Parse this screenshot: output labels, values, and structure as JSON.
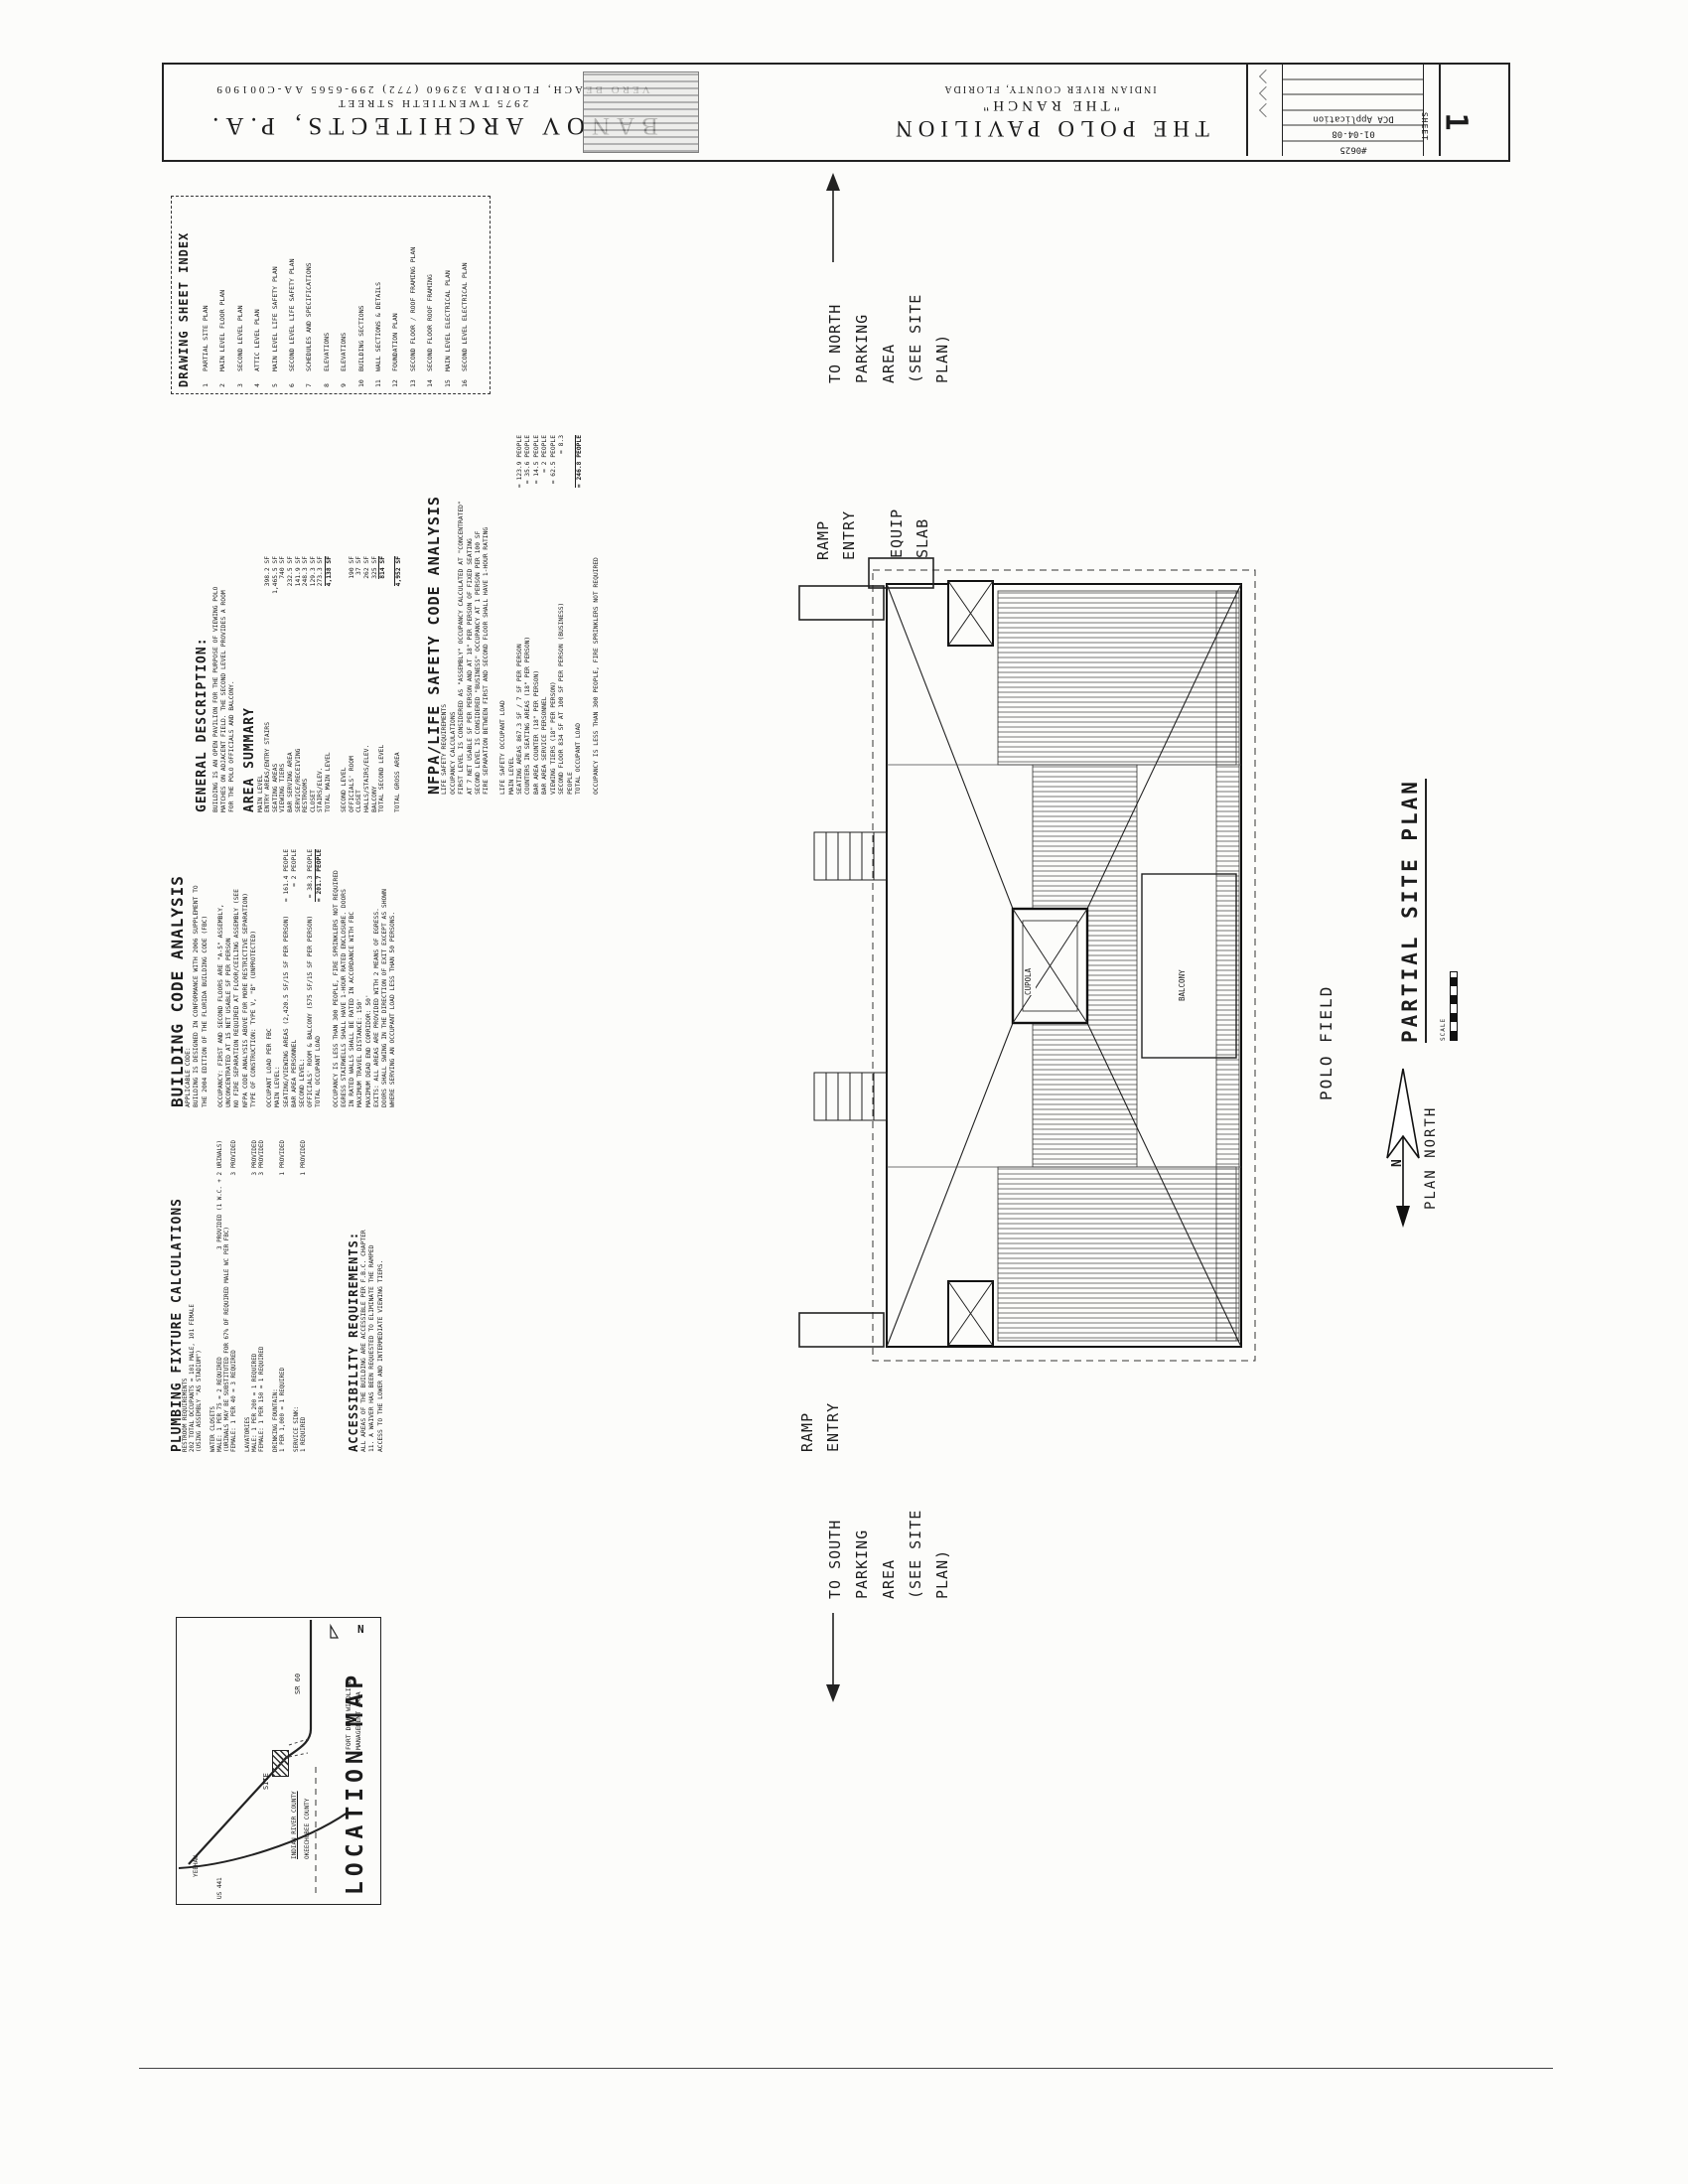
{
  "title_block": {
    "architect": {
      "name": "BANOV ARCHITECTS, P.A.",
      "address": "2975 TWENTIETH STREET",
      "city_line": "VERO BEACH, FLORIDA 32960 (772) 299-6565 AA-C001909"
    },
    "project": {
      "name": "THE POLO PAVILION",
      "subtitle": "\"THE RANCH\"",
      "location": "INDIAN RIVER COUNTY, FLORIDA"
    },
    "info_rows": [
      "",
      "",
      "",
      "DCA Application",
      "01-04-08",
      "#0625"
    ],
    "sheet_label": "SHEET",
    "sheet_number": "1"
  },
  "sheet_index": {
    "title": "DRAWING SHEET INDEX",
    "entries": [
      {
        "num": "1",
        "label": "PARTIAL SITE PLAN"
      },
      {
        "num": "2",
        "label": "MAIN LEVEL FLOOR PLAN"
      },
      {
        "num": "3",
        "label": "SECOND LEVEL PLAN"
      },
      {
        "num": "4",
        "label": "ATTIC LEVEL PLAN"
      },
      {
        "num": "5",
        "label": "MAIN LEVEL LIFE SAFETY PLAN"
      },
      {
        "num": "6",
        "label": "SECOND LEVEL LIFE SAFETY PLAN"
      },
      {
        "num": "7",
        "label": "SCHEDULES AND SPECIFICATIONS"
      },
      {
        "num": "8",
        "label": "ELEVATIONS"
      },
      {
        "num": "9",
        "label": "ELEVATIONS"
      },
      {
        "num": "10",
        "label": "BUILDING SECTIONS"
      },
      {
        "num": "11",
        "label": "WALL SECTIONS & DETAILS"
      },
      {
        "num": "12",
        "label": "FOUNDATION PLAN"
      },
      {
        "num": "13",
        "label": "SECOND FLOOR / ROOF FRAMING PLAN"
      },
      {
        "num": "14",
        "label": "SECOND FLOOR ROOF FRAMING"
      },
      {
        "num": "15",
        "label": "MAIN LEVEL ELECTRICAL PLAN"
      },
      {
        "num": "16",
        "label": "SECOND LEVEL ELECTRICAL PLAN"
      }
    ]
  },
  "general_description": {
    "title": "GENERAL DESCRIPTION:",
    "lines": [
      "BUILDING IS AN OPEN PAVILION FOR THE PURPOSE OF VIEWING POLO",
      "MATCHES ON ADJACENT FIELD.  THE SECOND LEVEL PROVIDES A ROOM",
      "FOR THE POLO OFFICIALS AND BALCONY."
    ]
  },
  "area_summary": {
    "title": "AREA SUMMARY",
    "main_level_label": "MAIN LEVEL",
    "main_rows": [
      {
        "label": "ENTRY AREAS/ENTRY STAIRS",
        "value": "398.2 SF"
      },
      {
        "label": "SEATING AREAS",
        "value": "1,465.5 SF"
      },
      {
        "label": "VIEWING TIERS",
        "value": "740 SF"
      },
      {
        "label": "BAR SERVING AREA",
        "value": "232.5 SF"
      },
      {
        "label": "SERVICE/RECEIVING",
        "value": "141.9 SF"
      },
      {
        "label": "RESTROOMS",
        "value": "248.3 SF"
      },
      {
        "label": "CLOSET",
        "value": "129.3 SF"
      },
      {
        "label": "STAIRS/ELEV.",
        "value": "273.3 SF"
      }
    ],
    "main_total": {
      "label": "TOTAL MAIN LEVEL",
      "value": "4,138 SF"
    },
    "second_level_label": "SECOND LEVEL",
    "second_rows": [
      {
        "label": "OFFICIALS' ROOM",
        "value": "190 SF"
      },
      {
        "label": "CLOSET",
        "value": "37 SF"
      },
      {
        "label": "HALLS/STAIRS/ELEV.",
        "value": "262 SF"
      },
      {
        "label": "BALCONY",
        "value": "325 SF"
      }
    ],
    "second_total": {
      "label": "TOTAL SECOND LEVEL",
      "value": "814 SF"
    },
    "gross_total": {
      "label": "TOTAL GROSS AREA",
      "value": "4,952 SF"
    }
  },
  "nfpa": {
    "title": "NFPA/LIFE SAFETY CODE ANALYSIS",
    "intro_lines": [
      "LIFE SAFETY REQUIREMENTS",
      "OCCUPANCY CALCULATIONS",
      "FIRST LEVEL IS CONSIDERED AS \"ASSEMBLY\" OCCUPANCY CALCULATED AT \"CONCENTRATED\"",
      "AT 7 NET USABLE SF PER PERSON AND AT 18\" PER PERSON OF FIXED SEATING",
      "SECOND LEVEL IS CONSIDERED \"BUSINESS\" OCCUPANCY AT 1 PERSON PER 100 SF",
      "FIRE SEPARATION BETWEEN FIRST AND SECOND FLOOR SHALL HAVE 1-HOUR RATING",
      ""
    ],
    "load_title": "LIFE SAFETY OCCUPANT LOAD",
    "level_label": "MAIN LEVEL",
    "load_rows": [
      {
        "label": "SEATING AREAS 867.3 SF / 7 SF PER PERSON",
        "value": "= 123.9 PEOPLE"
      },
      {
        "label": "COUNTERS IN SEATING AREAS (18\" PER PERSON)",
        "value": "= 35.6 PEOPLE"
      },
      {
        "label": "BAR AREA COUNTER (18\" PER PERSON)",
        "value": "= 14.5 PEOPLE"
      },
      {
        "label": "BAR AREA SERVICE PERSONNEL",
        "value": "= 2 PEOPLE"
      },
      {
        "label": "VIEWING TIERS (18\" PER PERSON)",
        "value": "= 62.5 PEOPLE"
      },
      {
        "label": "SECOND FLOOR 834 SF AT 100 SF PER PERSON (BUSINESS)",
        "value": "= 8.3"
      },
      {
        "label": "PEOPLE",
        "value": ""
      }
    ],
    "total": {
      "label": "TOTAL OCCUPANT LOAD",
      "value": "= 246.8 PEOPLE"
    },
    "note": "OCCUPANCY IS LESS THAN 300 PEOPLE, FIRE SPRINKLERS NOT REQUIRED"
  },
  "building_code": {
    "title": "BUILDING CODE ANALYSIS",
    "lines1": [
      "APPLICABLE CODE:",
      "BUILDING IS DESIGNED IN CONFORMANCE WITH 2006 SUPPLEMENT TO",
      "THE 2004 EDITION OF THE FLORIDA BUILDING CODE (FBC)",
      "",
      "OCCUPANCY: FIRST AND SECOND FLOORS ARE \"A-5\" ASSEMBLY,",
      "UNCONCENTRATED AT 15 NET USABLE SF PER PERSON",
      "NO FIRE SEPARATION REQUIRED AT FLOOR/CEILING ASSEMBLY (SEE",
      "NFPA CODE ANALYSIS ABOVE FOR MORE RESTRICTIVE SEPARATION)",
      "TYPE OF CONSTRUCTION: TYPE V, \"B\" (UNPROTECTED)",
      ""
    ],
    "load_rows": [
      {
        "label": "OCCUPANT LOAD PER FBC",
        "value": ""
      },
      {
        "label": "MAIN LEVEL:",
        "value": ""
      },
      {
        "label": "SEATING/VIEWING AREAS (2,420.5 SF/15 SF PER PERSON)",
        "value": "= 161.4 PEOPLE"
      },
      {
        "label": "BAR AREA PERSONNEL",
        "value": "= 2 PEOPLE"
      },
      {
        "label": "SECOND LEVEL:",
        "value": ""
      },
      {
        "label": "OFFICIALS' ROOM & BALCONY (575 SF/15 SF PER PERSON)",
        "value": "= 38.3 PEOPLE"
      }
    ],
    "total": {
      "label": "TOTAL OCCUPANT LOAD",
      "value": "= 201.7 PEOPLE"
    },
    "lines2": [
      "",
      "OCCUPANCY IS LESS THAN 300 PEOPLE, FIRE SPRINKLERS NOT REQUIRED",
      "EGRESS STAIRWELLS SHALL HAVE 1-HOUR RATED ENCLOSURE. DOORS",
      "IN RATED WALLS SHALL BE RATED IN ACCORDANCE WITH FBC",
      "MAXIMUM TRAVEL DISTANCE: 150'",
      "MAXIMUM DEAD END CORRIDOR: 50'",
      "EXITS: ALL AREAS ARE PROVIDED WITH 2 MEANS OF EGRESS.",
      "DOORS SHALL SWING IN THE DIRECTION OF EXIT EXCEPT AS SHOWN",
      "WHERE SERVING AN OCCUPANT LOAD LESS THAN 50 PERSONS."
    ]
  },
  "plumbing": {
    "title": "PLUMBING FIXTURE CALCULATIONS",
    "rows": [
      {
        "label": "RESTROOM REQUIREMENTS",
        "value": ""
      },
      {
        "label": "202 TOTAL OCCUPANTS = 101 MALE, 101 FEMALE",
        "value": ""
      },
      {
        "label": "(USING ASSEMBLY \"AS STADIUM\")",
        "value": ""
      },
      {
        "label": "",
        "value": ""
      },
      {
        "label": "WATER CLOSETS",
        "value": ""
      },
      {
        "label": "MALE: 1 PER 75 = 2 REQUIRED",
        "value": "3 PROVIDED (1 W.C. + 2 URINALS)"
      },
      {
        "label": "(URINALS MAY BE SUBSTITUTED FOR 67% OF REQUIRED MALE WC PER FBC)",
        "value": ""
      },
      {
        "label": "FEMALE: 1 PER 40 = 3 REQUIRED",
        "value": "3 PROVIDED"
      },
      {
        "label": "",
        "value": ""
      },
      {
        "label": "LAVATORIES",
        "value": ""
      },
      {
        "label": "MALE: 1 PER 200 = 1 REQUIRED",
        "value": "3 PROVIDED"
      },
      {
        "label": "FEMALE: 1 PER 150 = 1 REQUIRED",
        "value": "3 PROVIDED"
      },
      {
        "label": "",
        "value": ""
      },
      {
        "label": "DRINKING FOUNTAIN:",
        "value": ""
      },
      {
        "label": "1 PER 1,000 = 1 REQUIRED",
        "value": "1 PROVIDED"
      },
      {
        "label": "",
        "value": ""
      },
      {
        "label": "SERVICE SINK:",
        "value": ""
      },
      {
        "label": "1 REQUIRED",
        "value": "1 PROVIDED"
      }
    ]
  },
  "accessibility": {
    "title": "ACCESSIBILITY REQUIREMENTS:",
    "lines": [
      "ALL AREAS OF THE BUILDING ARE ACCESSIBLE PER F.B.C. CHAPTER",
      "11.  A WAIVER HAS BEEN REQUESTED TO ELIMINATE THE RAMPED",
      "ACCESS TO THE LOWER AND INTERMEDIATE VIEWING TIERS."
    ]
  },
  "location_map": {
    "title": "LOCATION MAP",
    "north_letter": "N",
    "labels": {
      "sr60": "SR 60",
      "site": "SITE",
      "fort_drum": [
        "FORT DRUM WILDLIFE",
        "MANAGEMENT AREA"
      ],
      "county_top": "INDIAN RIVER COUNTY",
      "county_bottom": "OKEECHOBEE COUNTY",
      "yeehaw": "YEEHAW",
      "us441": "US 441"
    }
  },
  "site_plan": {
    "to_north": [
      "TO NORTH",
      "PARKING",
      "AREA",
      "(SEE SITE",
      "PLAN)"
    ],
    "to_south": [
      "TO SOUTH",
      "PARKING",
      "AREA",
      "(SEE SITE",
      "PLAN)"
    ],
    "ramp_entry": [
      "RAMP",
      "ENTRY"
    ],
    "equip_slab": [
      "EQUIP",
      "SLAB"
    ],
    "cupola": "CUPOLA",
    "balcony": "BALCONY",
    "polo_field": "POLO FIELD",
    "plan_title": "PARTIAL SITE PLAN",
    "scale_label": "SCALE",
    "plan_north": "PLAN NORTH",
    "north_letter": "N"
  }
}
